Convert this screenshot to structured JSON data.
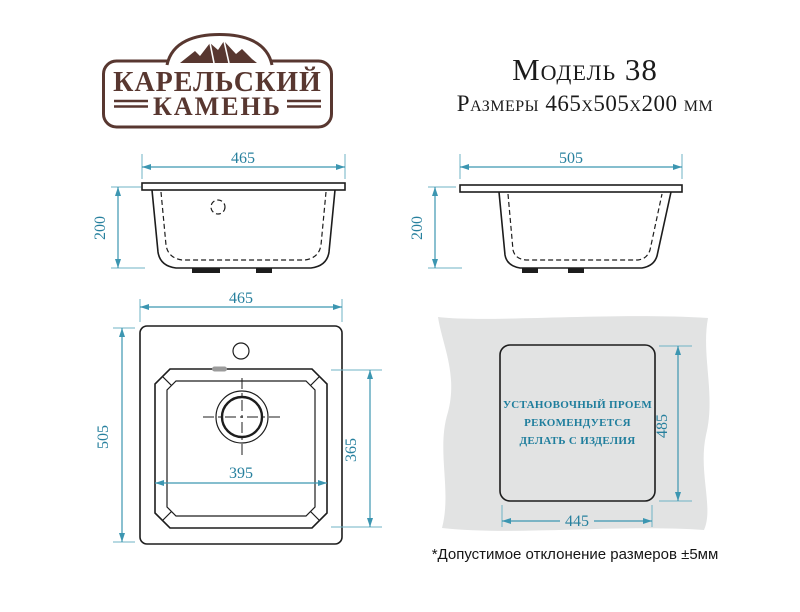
{
  "brand": {
    "name_line1": "КАРЕЛЬСКИЙ",
    "name_line2": "КАМЕНЬ"
  },
  "header": {
    "model_title": "Модель 38",
    "dimensions_subtitle": "Размеры 465х505х200 мм"
  },
  "front_view": {
    "width_mm": "465",
    "height_mm": "200"
  },
  "side_view": {
    "depth_mm": "505",
    "height_mm": "200"
  },
  "top_view": {
    "width_mm": "465",
    "depth_mm": "505",
    "bowl_width_mm": "395",
    "bowl_depth_mm": "365"
  },
  "install_view": {
    "opening_height_mm": "485",
    "opening_width_mm": "445",
    "instruction_line1": "УСТАНОВОЧНЫЙ ПРОЕМ",
    "instruction_line2": "РЕКОМЕНДУЕТСЯ",
    "instruction_line3": "ДЕЛАТЬ С ИЗДЕЛИЯ"
  },
  "footnote": "*Допустимое отклонение размеров ±5мм",
  "colors": {
    "dimension_teal": "#3c96b1",
    "line_black": "#1d1d1d",
    "brand_brown": "#583730",
    "countertop_gray": "#e2e3e3"
  }
}
